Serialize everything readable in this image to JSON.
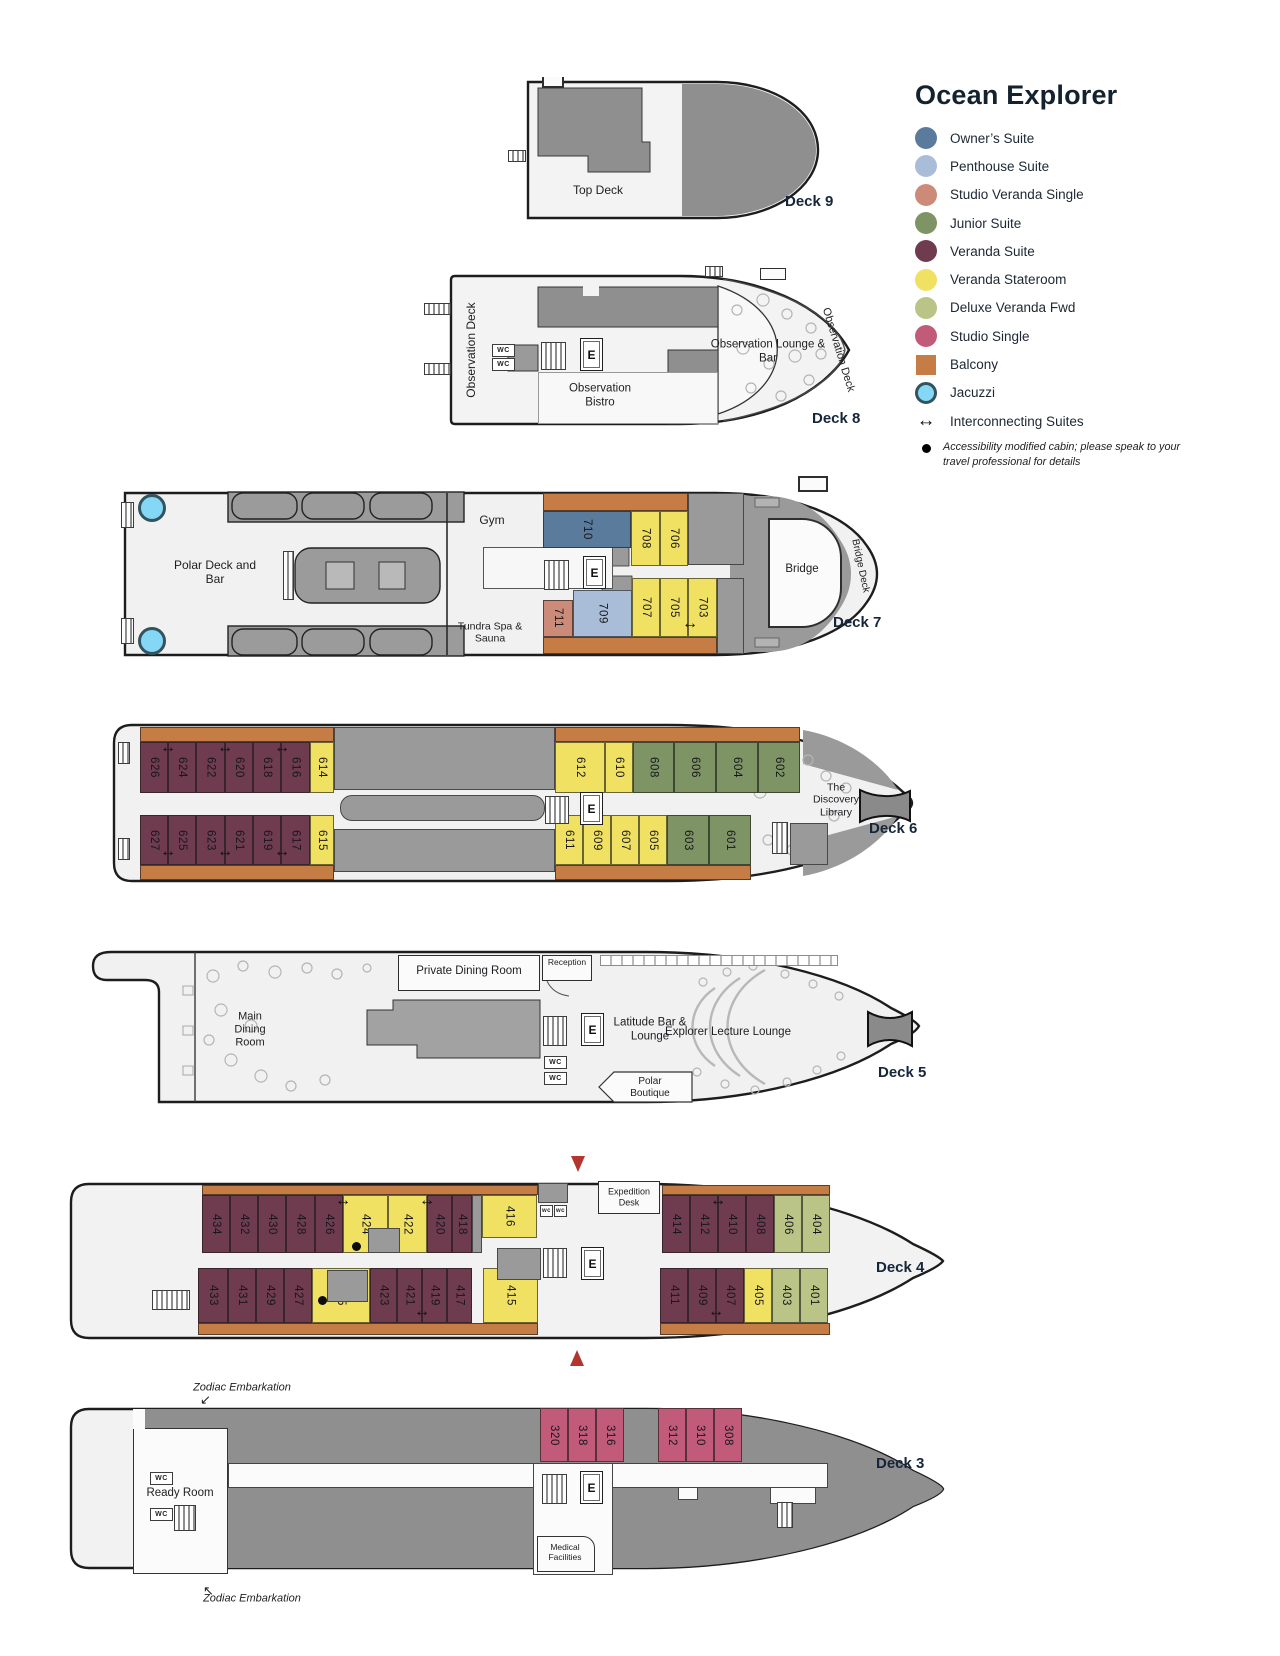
{
  "title": "Ocean Explorer",
  "colors": {
    "owner": "#5b7b9c",
    "penthouse": "#a9bdd9",
    "studio_veranda_single": "#cb8b78",
    "junior": "#7e9465",
    "veranda_suite": "#6e3c4e",
    "veranda_stateroom": "#f0e163",
    "deluxe_veranda_fwd": "#b9c486",
    "studio_single": "#c25b7a",
    "balcony": "#c67d45",
    "jacuzzi": "#85d8f5",
    "structure": "#9a9a9a",
    "hull": "#f1f1f1",
    "accent_red": "#b2352e"
  },
  "legend": {
    "items": [
      {
        "label": "Owner’s Suite",
        "type": "owner",
        "shape": "circle"
      },
      {
        "label": "Penthouse Suite",
        "type": "penthouse",
        "shape": "circle"
      },
      {
        "label": "Studio Veranda Single",
        "type": "studio_veranda_single",
        "shape": "circle"
      },
      {
        "label": "Junior Suite",
        "type": "junior",
        "shape": "circle"
      },
      {
        "label": "Veranda Suite",
        "type": "veranda_suite",
        "shape": "circle"
      },
      {
        "label": "Veranda Stateroom",
        "type": "veranda_stateroom",
        "shape": "circle"
      },
      {
        "label": "Deluxe Veranda Fwd",
        "type": "deluxe_veranda_fwd",
        "shape": "circle"
      },
      {
        "label": "Studio Single",
        "type": "studio_single",
        "shape": "circle"
      },
      {
        "label": "Balcony",
        "type": "balcony",
        "shape": "square"
      },
      {
        "label": "Jacuzzi",
        "type": "jacuzzi",
        "shape": "jacuzzi"
      },
      {
        "label": "Interconnecting Suites",
        "shape": "arrow"
      }
    ],
    "note": "Accessibility modified cabin; please speak to your travel professional for details"
  },
  "labels": {
    "elevator": "E",
    "wc": "WC",
    "wc_small": "wc",
    "interconnect": "↔"
  },
  "decks": {
    "deck9": "Deck 9",
    "deck8": "Deck 8",
    "deck7": "Deck 7",
    "deck6": "Deck 6",
    "deck5": "Deck 5",
    "deck4": "Deck 4",
    "deck3": "Deck 3"
  },
  "areas": {
    "deck9": {
      "top_deck": "Top Deck"
    },
    "deck8": {
      "obs_deck_port": "Observation Deck",
      "bistro": "Observation Bistro",
      "lounge": "Observation Lounge & Bar",
      "obs_deck_stbd": "Observation Deck"
    },
    "deck7": {
      "polar": "Polar Deck and Bar",
      "gym": "Gym",
      "tundra": "Tundra Spa & Sauna",
      "bridge": "Bridge",
      "bridge_deck": "Bridge Deck"
    },
    "deck6": {
      "library": "The Discovery Library"
    },
    "deck5": {
      "main_dining": "Main Dining Room",
      "private_dining": "Private Dining Room",
      "reception": "Reception",
      "latitude": "Latitude Bar & Lounge",
      "lecture": "Explorer Lecture Lounge",
      "polar_boutique": "Polar Boutique"
    },
    "deck4": {
      "expedition": "Expedition Desk"
    },
    "deck3": {
      "ready_room": "Ready Room",
      "medical": "Medical Facilities",
      "zodiac": "Zodiac Embarkation"
    }
  },
  "rects": [
    {
      "t": "balcony",
      "x": 543,
      "y": 493,
      "w": 145,
      "h": 18
    },
    {
      "t": "balcony",
      "x": 543,
      "y": 637,
      "w": 174,
      "h": 17
    },
    {
      "t": "structure",
      "x": 688,
      "y": 493,
      "w": 56,
      "h": 72
    },
    {
      "t": "structure",
      "x": 717,
      "y": 578,
      "w": 27,
      "h": 76
    },
    {
      "n": "710",
      "t": "owner",
      "x": 543,
      "y": 511,
      "w": 88,
      "h": 37
    },
    {
      "n": "708",
      "t": "veranda_stateroom",
      "x": 631,
      "y": 511,
      "w": 29,
      "h": 55
    },
    {
      "n": "706",
      "t": "veranda_stateroom",
      "x": 660,
      "y": 511,
      "w": 28,
      "h": 55
    },
    {
      "n": "711",
      "t": "studio_veranda_single",
      "x": 543,
      "y": 600,
      "w": 30,
      "h": 37
    },
    {
      "n": "709",
      "t": "penthouse",
      "x": 573,
      "y": 590,
      "w": 59,
      "h": 47
    },
    {
      "n": "707",
      "t": "veranda_stateroom",
      "x": 632,
      "y": 578,
      "w": 28,
      "h": 59
    },
    {
      "n": "705",
      "t": "veranda_stateroom",
      "x": 660,
      "y": 578,
      "w": 28,
      "h": 59
    },
    {
      "n": "703",
      "t": "veranda_stateroom",
      "x": 688,
      "y": 578,
      "w": 29,
      "h": 59
    },
    {
      "t": "balcony",
      "x": 140,
      "y": 727,
      "w": 194,
      "h": 15
    },
    {
      "t": "balcony",
      "x": 555,
      "y": 727,
      "w": 245,
      "h": 15
    },
    {
      "t": "balcony",
      "x": 140,
      "y": 865,
      "w": 194,
      "h": 15
    },
    {
      "t": "balcony",
      "x": 555,
      "y": 865,
      "w": 196,
      "h": 15
    },
    {
      "t": "structure",
      "x": 334,
      "y": 727,
      "w": 221,
      "h": 63
    },
    {
      "t": "structure",
      "x": 340,
      "y": 795,
      "w": 205,
      "h": 26,
      "r": 12
    },
    {
      "t": "structure",
      "x": 334,
      "y": 829,
      "w": 221,
      "h": 43
    },
    {
      "t": "structure",
      "x": 790,
      "y": 823,
      "w": 38,
      "h": 42
    },
    {
      "n": "626",
      "t": "veranda_suite",
      "x": 140,
      "y": 742,
      "w": 28,
      "h": 51
    },
    {
      "n": "624",
      "t": "veranda_suite",
      "x": 168,
      "y": 742,
      "w": 28,
      "h": 51
    },
    {
      "n": "622",
      "t": "veranda_suite",
      "x": 196,
      "y": 742,
      "w": 29,
      "h": 51
    },
    {
      "n": "620",
      "t": "veranda_suite",
      "x": 225,
      "y": 742,
      "w": 28,
      "h": 51
    },
    {
      "n": "618",
      "t": "veranda_suite",
      "x": 253,
      "y": 742,
      "w": 28,
      "h": 51
    },
    {
      "n": "616",
      "t": "veranda_suite",
      "x": 281,
      "y": 742,
      "w": 29,
      "h": 51
    },
    {
      "n": "614",
      "t": "veranda_stateroom",
      "x": 310,
      "y": 742,
      "w": 24,
      "h": 51
    },
    {
      "n": "612",
      "t": "veranda_stateroom",
      "x": 555,
      "y": 742,
      "w": 50,
      "h": 51
    },
    {
      "n": "610",
      "t": "veranda_stateroom",
      "x": 605,
      "y": 742,
      "w": 28,
      "h": 51
    },
    {
      "n": "608",
      "t": "junior",
      "x": 633,
      "y": 742,
      "w": 41,
      "h": 51
    },
    {
      "n": "606",
      "t": "junior",
      "x": 674,
      "y": 742,
      "w": 42,
      "h": 51
    },
    {
      "n": "604",
      "t": "junior",
      "x": 716,
      "y": 742,
      "w": 42,
      "h": 51
    },
    {
      "n": "602",
      "t": "junior",
      "x": 758,
      "y": 742,
      "w": 42,
      "h": 51
    },
    {
      "n": "627",
      "t": "veranda_suite",
      "x": 140,
      "y": 815,
      "w": 28,
      "h": 50
    },
    {
      "n": "625",
      "t": "veranda_suite",
      "x": 168,
      "y": 815,
      "w": 28,
      "h": 50
    },
    {
      "n": "623",
      "t": "veranda_suite",
      "x": 196,
      "y": 815,
      "w": 29,
      "h": 50
    },
    {
      "n": "621",
      "t": "veranda_suite",
      "x": 225,
      "y": 815,
      "w": 28,
      "h": 50
    },
    {
      "n": "619",
      "t": "veranda_suite",
      "x": 253,
      "y": 815,
      "w": 28,
      "h": 50
    },
    {
      "n": "617",
      "t": "veranda_suite",
      "x": 281,
      "y": 815,
      "w": 29,
      "h": 50
    },
    {
      "n": "615",
      "t": "veranda_stateroom",
      "x": 310,
      "y": 815,
      "w": 24,
      "h": 50
    },
    {
      "n": "611",
      "t": "veranda_stateroom",
      "x": 555,
      "y": 815,
      "w": 28,
      "h": 50
    },
    {
      "n": "609",
      "t": "veranda_stateroom",
      "x": 583,
      "y": 815,
      "w": 28,
      "h": 50
    },
    {
      "n": "607",
      "t": "veranda_stateroom",
      "x": 611,
      "y": 815,
      "w": 28,
      "h": 50
    },
    {
      "n": "605",
      "t": "veranda_stateroom",
      "x": 639,
      "y": 815,
      "w": 28,
      "h": 50
    },
    {
      "n": "603",
      "t": "junior",
      "x": 667,
      "y": 815,
      "w": 42,
      "h": 50
    },
    {
      "n": "601",
      "t": "junior",
      "x": 709,
      "y": 815,
      "w": 42,
      "h": 50
    },
    {
      "t": "balcony",
      "x": 202,
      "y": 1185,
      "w": 336,
      "h": 10
    },
    {
      "t": "balcony",
      "x": 662,
      "y": 1185,
      "w": 168,
      "h": 10
    },
    {
      "t": "balcony",
      "x": 198,
      "y": 1323,
      "w": 340,
      "h": 12
    },
    {
      "t": "balcony",
      "x": 660,
      "y": 1323,
      "w": 170,
      "h": 12
    },
    {
      "n": "434",
      "t": "veranda_suite",
      "x": 202,
      "y": 1195,
      "w": 28,
      "h": 58
    },
    {
      "n": "432",
      "t": "veranda_suite",
      "x": 230,
      "y": 1195,
      "w": 28,
      "h": 58
    },
    {
      "n": "430",
      "t": "veranda_suite",
      "x": 258,
      "y": 1195,
      "w": 28,
      "h": 58
    },
    {
      "n": "428",
      "t": "veranda_suite",
      "x": 286,
      "y": 1195,
      "w": 29,
      "h": 58
    },
    {
      "n": "426",
      "t": "veranda_suite",
      "x": 315,
      "y": 1195,
      "w": 28,
      "h": 58
    },
    {
      "n": "424",
      "t": "veranda_stateroom",
      "x": 343,
      "y": 1195,
      "w": 45,
      "h": 58
    },
    {
      "n": "422",
      "t": "veranda_stateroom",
      "x": 388,
      "y": 1195,
      "w": 39,
      "h": 58
    },
    {
      "n": "420",
      "t": "veranda_suite",
      "x": 427,
      "y": 1195,
      "w": 25,
      "h": 58
    },
    {
      "n": "418",
      "t": "veranda_suite",
      "x": 452,
      "y": 1195,
      "w": 20,
      "h": 58
    },
    {
      "n": "416",
      "t": "veranda_stateroom",
      "x": 482,
      "y": 1195,
      "w": 55,
      "h": 43
    },
    {
      "n": "414",
      "t": "veranda_suite",
      "x": 662,
      "y": 1195,
      "w": 28,
      "h": 58
    },
    {
      "n": "412",
      "t": "veranda_suite",
      "x": 690,
      "y": 1195,
      "w": 28,
      "h": 58
    },
    {
      "n": "410",
      "t": "veranda_suite",
      "x": 718,
      "y": 1195,
      "w": 28,
      "h": 58
    },
    {
      "n": "408",
      "t": "veranda_suite",
      "x": 746,
      "y": 1195,
      "w": 28,
      "h": 58
    },
    {
      "n": "406",
      "t": "deluxe_veranda_fwd",
      "x": 774,
      "y": 1195,
      "w": 28,
      "h": 58
    },
    {
      "n": "404",
      "t": "deluxe_veranda_fwd",
      "x": 802,
      "y": 1195,
      "w": 28,
      "h": 58
    },
    {
      "n": "433",
      "t": "veranda_suite",
      "x": 198,
      "y": 1268,
      "w": 30,
      "h": 55
    },
    {
      "n": "431",
      "t": "veranda_suite",
      "x": 228,
      "y": 1268,
      "w": 28,
      "h": 55
    },
    {
      "n": "429",
      "t": "veranda_suite",
      "x": 256,
      "y": 1268,
      "w": 28,
      "h": 55
    },
    {
      "n": "427",
      "t": "veranda_suite",
      "x": 284,
      "y": 1268,
      "w": 28,
      "h": 55
    },
    {
      "n": "425",
      "t": "veranda_stateroom",
      "x": 312,
      "y": 1268,
      "w": 58,
      "h": 55
    },
    {
      "n": "423",
      "t": "veranda_suite",
      "x": 370,
      "y": 1268,
      "w": 27,
      "h": 55
    },
    {
      "n": "421",
      "t": "veranda_suite",
      "x": 397,
      "y": 1268,
      "w": 25,
      "h": 55
    },
    {
      "n": "419",
      "t": "veranda_suite",
      "x": 422,
      "y": 1268,
      "w": 25,
      "h": 55
    },
    {
      "n": "417",
      "t": "veranda_suite",
      "x": 447,
      "y": 1268,
      "w": 25,
      "h": 55
    },
    {
      "n": "415",
      "t": "veranda_stateroom",
      "x": 483,
      "y": 1268,
      "w": 55,
      "h": 55
    },
    {
      "n": "411",
      "t": "veranda_suite",
      "x": 660,
      "y": 1268,
      "w": 28,
      "h": 55
    },
    {
      "n": "409",
      "t": "veranda_suite",
      "x": 688,
      "y": 1268,
      "w": 28,
      "h": 55
    },
    {
      "n": "407",
      "t": "veranda_suite",
      "x": 716,
      "y": 1268,
      "w": 28,
      "h": 55
    },
    {
      "n": "405",
      "t": "veranda_stateroom",
      "x": 744,
      "y": 1268,
      "w": 28,
      "h": 55
    },
    {
      "n": "403",
      "t": "deluxe_veranda_fwd",
      "x": 772,
      "y": 1268,
      "w": 28,
      "h": 55
    },
    {
      "n": "401",
      "t": "deluxe_veranda_fwd",
      "x": 800,
      "y": 1268,
      "w": 28,
      "h": 55
    },
    {
      "t": "structure",
      "x": 538,
      "y": 1183,
      "w": 30,
      "h": 20
    },
    {
      "t": "structure",
      "x": 472,
      "y": 1195,
      "w": 10,
      "h": 58
    },
    {
      "t": "structure",
      "x": 368,
      "y": 1228,
      "w": 32,
      "h": 25
    },
    {
      "t": "structure",
      "x": 327,
      "y": 1270,
      "w": 41,
      "h": 32
    },
    {
      "t": "structure",
      "x": 497,
      "y": 1248,
      "w": 44,
      "h": 32
    },
    {
      "n": "320",
      "t": "studio_single",
      "x": 540,
      "y": 1408,
      "w": 28,
      "h": 54
    },
    {
      "n": "318",
      "t": "studio_single",
      "x": 568,
      "y": 1408,
      "w": 28,
      "h": 54
    },
    {
      "n": "316",
      "t": "studio_single",
      "x": 596,
      "y": 1408,
      "w": 28,
      "h": 54
    },
    {
      "n": "312",
      "t": "studio_single",
      "x": 658,
      "y": 1408,
      "w": 28,
      "h": 54
    },
    {
      "n": "310",
      "t": "studio_single",
      "x": 686,
      "y": 1408,
      "w": 28,
      "h": 54
    },
    {
      "n": "308",
      "t": "studio_single",
      "x": 714,
      "y": 1408,
      "w": 28,
      "h": 54
    }
  ],
  "connectors": [
    {
      "x": 690,
      "y": 624
    },
    {
      "x": 168,
      "y": 748
    },
    {
      "x": 225,
      "y": 748
    },
    {
      "x": 282,
      "y": 748
    },
    {
      "x": 168,
      "y": 852
    },
    {
      "x": 225,
      "y": 852
    },
    {
      "x": 282,
      "y": 852
    },
    {
      "x": 343,
      "y": 1201
    },
    {
      "x": 427,
      "y": 1201
    },
    {
      "x": 718,
      "y": 1201
    },
    {
      "x": 422,
      "y": 1312
    },
    {
      "x": 716,
      "y": 1312
    }
  ],
  "dots": [
    {
      "x": 352,
      "y": 1242
    },
    {
      "x": 318,
      "y": 1296
    }
  ],
  "elevators": [
    {
      "x": 580,
      "y": 338
    },
    {
      "x": 583,
      "y": 556
    },
    {
      "x": 580,
      "y": 792
    },
    {
      "x": 581,
      "y": 1013
    },
    {
      "x": 581,
      "y": 1247
    },
    {
      "x": 580,
      "y": 1471
    }
  ],
  "wcs": [
    {
      "x": 492,
      "y": 344
    },
    {
      "x": 492,
      "y": 358
    },
    {
      "x": 544,
      "y": 1056
    },
    {
      "x": 544,
      "y": 1072
    },
    {
      "x": 150,
      "y": 1472
    },
    {
      "x": 150,
      "y": 1508
    }
  ],
  "wcs_small": [
    {
      "x": 540,
      "y": 1205
    },
    {
      "x": 554,
      "y": 1205
    }
  ],
  "stairs": [
    {
      "x": 508,
      "y": 150,
      "w": 18,
      "h": 12
    },
    {
      "x": 424,
      "y": 303,
      "w": 27,
      "h": 12
    },
    {
      "x": 424,
      "y": 363,
      "w": 27,
      "h": 12
    },
    {
      "x": 705,
      "y": 266,
      "w": 18,
      "h": 11
    },
    {
      "x": 541,
      "y": 342,
      "w": 25,
      "h": 28
    },
    {
      "x": 121,
      "y": 502,
      "w": 13,
      "h": 26
    },
    {
      "x": 121,
      "y": 618,
      "w": 13,
      "h": 26
    },
    {
      "x": 544,
      "y": 560,
      "w": 25,
      "h": 30
    },
    {
      "x": 283,
      "y": 551,
      "w": 11,
      "h": 49
    },
    {
      "x": 118,
      "y": 742,
      "w": 12,
      "h": 22
    },
    {
      "x": 118,
      "y": 838,
      "w": 12,
      "h": 22
    },
    {
      "x": 545,
      "y": 796,
      "w": 24,
      "h": 28
    },
    {
      "x": 772,
      "y": 822,
      "w": 16,
      "h": 32
    },
    {
      "x": 543,
      "y": 1016,
      "w": 24,
      "h": 30
    },
    {
      "x": 543,
      "y": 1248,
      "w": 24,
      "h": 30
    },
    {
      "x": 152,
      "y": 1290,
      "w": 38,
      "h": 20
    },
    {
      "x": 542,
      "y": 1474,
      "w": 25,
      "h": 30
    },
    {
      "x": 174,
      "y": 1505,
      "w": 22,
      "h": 26
    },
    {
      "x": 777,
      "y": 1502,
      "w": 16,
      "h": 26
    }
  ],
  "jacuzzis": [
    {
      "x": 138,
      "y": 494
    },
    {
      "x": 138,
      "y": 627
    }
  ],
  "red_arrows": [
    {
      "x": 571,
      "y": 1156,
      "dir": "down"
    },
    {
      "x": 570,
      "y": 1350,
      "dir": "up"
    }
  ]
}
